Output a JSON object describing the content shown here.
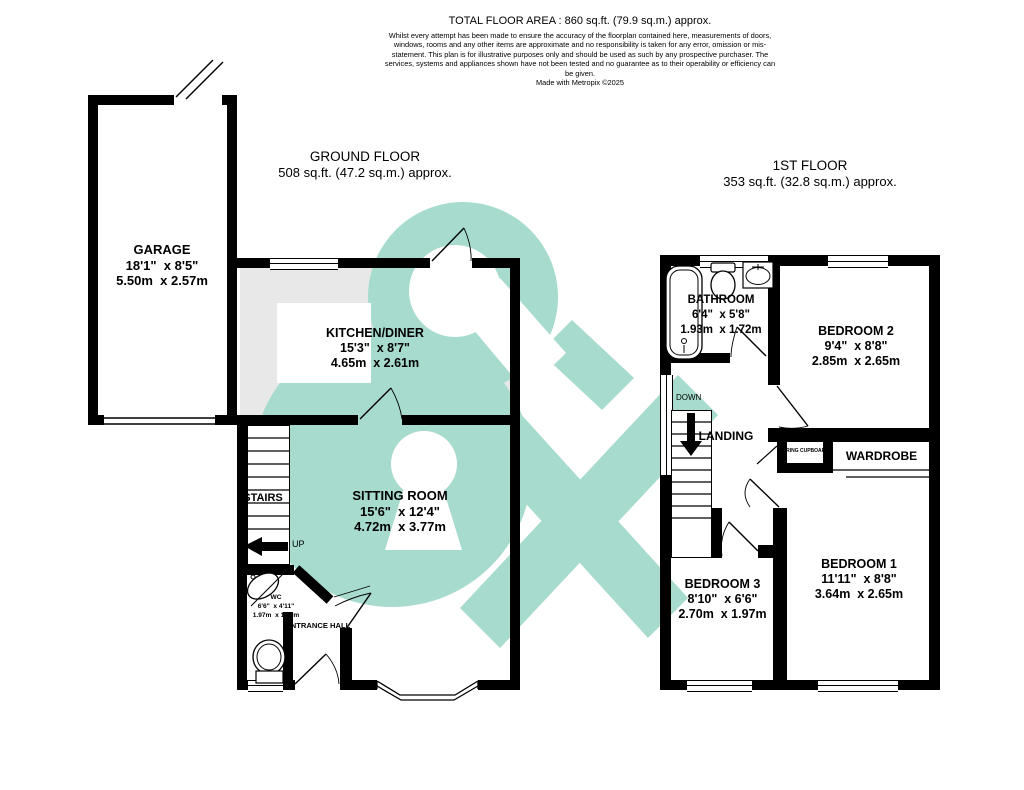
{
  "header": {
    "title": "TOTAL FLOOR AREA : 860 sq.ft. (79.9 sq.m.) approx.",
    "disclaimer": "Whilst every attempt has been made to ensure the accuracy of the floorplan contained here, measurements of doors, windows, rooms and any other items are approximate and no responsibility is taken for any error, omission or mis-statement. This plan is for illustrative purposes only and should be used as such by any prospective purchaser. The services, systems and appliances shown have not been tested and no guarantee as to their operability or efficiency can be given.",
    "credit": "Made with Metropix ©2025"
  },
  "ground_floor": {
    "title": "GROUND FLOOR",
    "area": "508 sq.ft. (47.2 sq.m.) approx.",
    "rooms": {
      "garage": {
        "name": "GARAGE",
        "imperial": "18'1\"  x 8'5\"",
        "metric": "5.50m  x 2.57m"
      },
      "kitchen": {
        "name": "KITCHEN/DINER",
        "imperial": "15'3\"  x 8'7\"",
        "metric": "4.65m  x 2.61m"
      },
      "sitting": {
        "name": "SITTING ROOM",
        "imperial": "15'6\"  x 12'4\"",
        "metric": "4.72m  x 3.77m"
      },
      "wc": {
        "name": "WC",
        "imperial": "6'6\"  x 4'11\"",
        "metric": "1.97m  x 1.49m"
      },
      "hall": {
        "name": "ENTRANCE HALL"
      },
      "stairs": {
        "name": "STAIRS",
        "direction": "UP"
      }
    }
  },
  "first_floor": {
    "title": "1ST FLOOR",
    "area": "353 sq.ft. (32.8 sq.m.) approx.",
    "rooms": {
      "bathroom": {
        "name": "BATHROOM",
        "imperial": "6'4\"  x 5'8\"",
        "metric": "1.93m  x 1.72m"
      },
      "bedroom2": {
        "name": "BEDROOM 2",
        "imperial": "9'4\"  x 8'8\"",
        "metric": "2.85m  x 2.65m"
      },
      "bedroom1": {
        "name": "BEDROOM 1",
        "imperial": "11'11\"  x 8'8\"",
        "metric": "3.64m  x 2.65m"
      },
      "bedroom3": {
        "name": "BEDROOM 3",
        "imperial": "8'10\"  x 6'6\"",
        "metric": "2.70m  x 1.97m"
      },
      "landing": {
        "name": "LANDING",
        "direction": "DOWN"
      },
      "wardrobe": {
        "name": "WARDROBE"
      },
      "airing": {
        "name": "AIRING CUPBOARD"
      }
    }
  },
  "watermark": {
    "color": "#a7dbce"
  },
  "palette": {
    "wall": "#000000",
    "kitchen_floor": "#e8e8e8"
  }
}
